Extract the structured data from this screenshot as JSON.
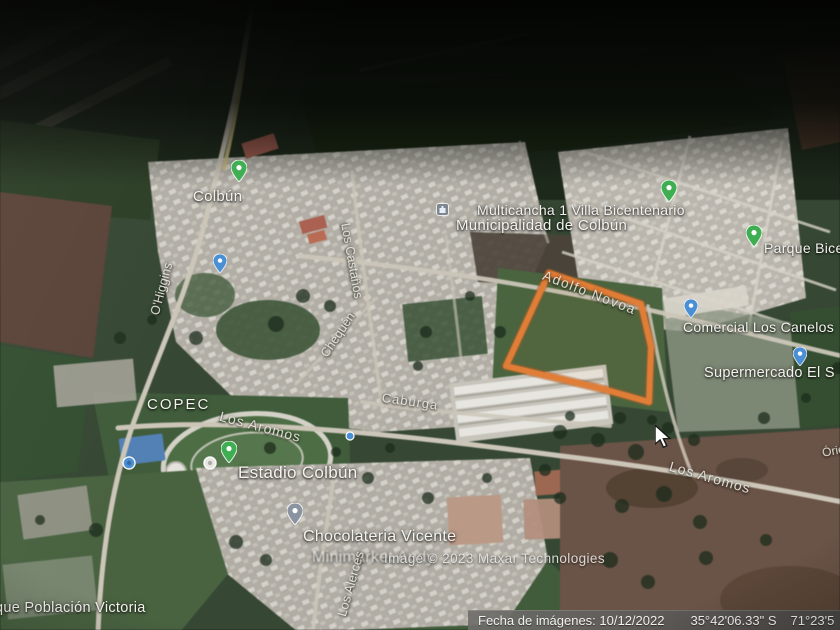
{
  "app": {
    "view": "satellite-imagery",
    "place": "Colbún"
  },
  "place_labels": [
    {
      "id": "colbun",
      "text": "Colbún"
    },
    {
      "id": "multicancha",
      "text": "Multicancha 1 Villa Bicentenario"
    },
    {
      "id": "municipalidad",
      "text": "Municipalidad de Colbún"
    },
    {
      "id": "comercial",
      "text": "Comercial Los Canelos"
    },
    {
      "id": "supermercado",
      "text": "Supermercado El S"
    },
    {
      "id": "parque-bicentenario",
      "text": "Parque Bicen"
    },
    {
      "id": "copec",
      "text": "COPEC"
    },
    {
      "id": "estadio",
      "text": "Estadio Colbún"
    },
    {
      "id": "chocolateria",
      "text": "Chocolateria Vicente"
    },
    {
      "id": "minimarket",
      "text": "Minimarket Andy"
    },
    {
      "id": "poblacion-victoria",
      "text": "que Población Victoria"
    }
  ],
  "street_labels": [
    {
      "id": "adolfo-novoa",
      "text": "Adolfo Novoa"
    },
    {
      "id": "los-aromos-west",
      "text": "Los Aromos"
    },
    {
      "id": "los-aromos-east",
      "text": "Los Aromos"
    },
    {
      "id": "ohiggins",
      "text": "O'Higgins"
    },
    {
      "id": "los-castanos",
      "text": "Los Castaños"
    },
    {
      "id": "chequen",
      "text": "Chequén"
    },
    {
      "id": "caburga",
      "text": "Caburga"
    },
    {
      "id": "los-alerces",
      "text": "Los Alerces"
    },
    {
      "id": "oriente",
      "text": "Órie"
    }
  ],
  "pins": [
    {
      "id": "pin-colbun",
      "kind": "place-pin",
      "color": "#3fae52"
    },
    {
      "id": "pin-villa",
      "kind": "place-pin",
      "color": "#3fae52"
    },
    {
      "id": "pin-parque",
      "kind": "place-pin",
      "color": "#3fae52"
    },
    {
      "id": "pin-estadio",
      "kind": "place-pin",
      "color": "#3fae52"
    },
    {
      "id": "pin-comercial",
      "kind": "shop-pin",
      "color": "#4a8fd4"
    },
    {
      "id": "pin-supermercado",
      "kind": "shop-pin",
      "color": "#4a8fd4"
    },
    {
      "id": "pin-ohiggins",
      "kind": "shop-pin",
      "color": "#4a8fd4"
    },
    {
      "id": "pin-aromos",
      "kind": "dot-pin",
      "color": "#4a8fd4"
    },
    {
      "id": "pin-stadium-circle",
      "kind": "circle-pin",
      "color": "#e9e7e1"
    },
    {
      "id": "pin-gym",
      "kind": "circle-pin",
      "color": "#4a8fd4"
    },
    {
      "id": "pin-chocolateria",
      "kind": "place-pin",
      "color": "#8a93a0"
    },
    {
      "id": "icon-municipalidad",
      "kind": "building-icon",
      "color": "#7d8691"
    }
  ],
  "highlight": {
    "parcel_outline_color": "#ee7c2c"
  },
  "watermark": {
    "text": "Image © 2023 Maxar Technologies"
  },
  "statusbar": {
    "imagery_date": "Fecha de imágenes: 10/12/2022",
    "latitude": "35°42'06.33\" S",
    "longitude": "71°23'5"
  }
}
